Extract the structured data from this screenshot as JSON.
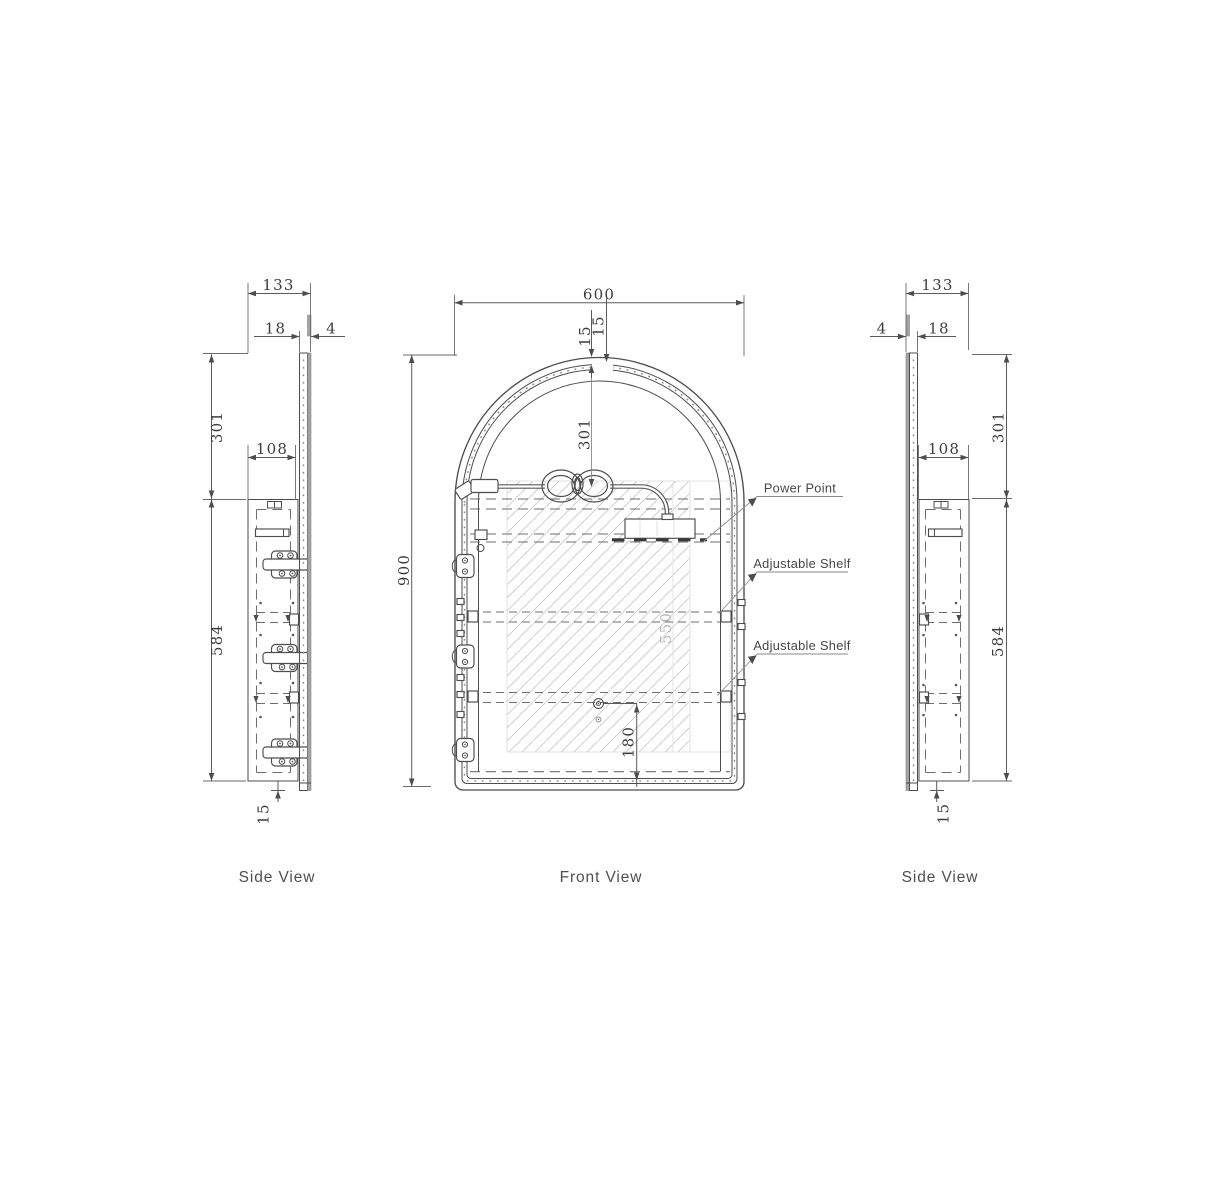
{
  "views": {
    "side_left": {
      "label": "Side View",
      "dims": {
        "overall_depth": "133",
        "door_thickness": "18",
        "mirror_thickness": "4",
        "arch_height": "301",
        "cabinet_depth": "108",
        "cabinet_height": "584",
        "bottom_overhang": "15"
      }
    },
    "front": {
      "label": "Front View",
      "dims": {
        "width": "600",
        "frame_a": "15",
        "frame_b": "15",
        "arch_height": "301",
        "height": "900",
        "internal_height": "550",
        "power_height": "180"
      },
      "callouts": {
        "power_point": "Power Point",
        "shelf_upper": "Adjustable Shelf",
        "shelf_lower": "Adjustable Shelf"
      }
    },
    "side_right": {
      "label": "Side View",
      "dims": {
        "overall_depth": "133",
        "mirror_thickness": "4",
        "door_thickness": "18",
        "arch_height": "301",
        "cabinet_depth": "108",
        "cabinet_height": "584",
        "bottom_overhang": "15"
      }
    }
  }
}
